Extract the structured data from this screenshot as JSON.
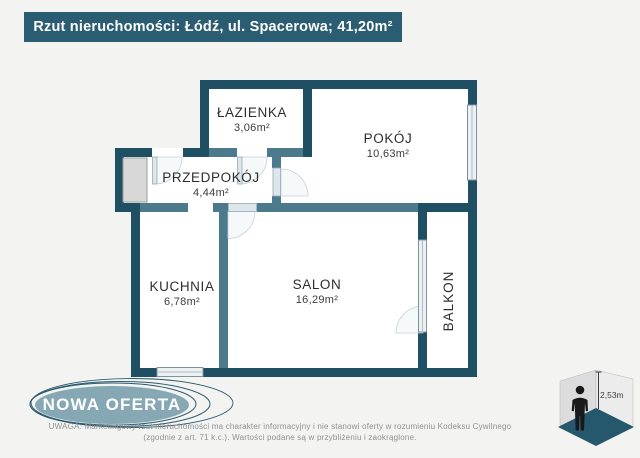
{
  "header": {
    "title": "Rzut nieruchomości: Łódź, ul. Spacerowa; 41,20m²"
  },
  "rooms": [
    {
      "name": "ŁAZIENKA",
      "area": "3,06m²"
    },
    {
      "name": "POKÓJ",
      "area": "10,63m²"
    },
    {
      "name": "PRZEDPOKÓJ",
      "area": "4,44m²"
    },
    {
      "name": "KUCHNIA",
      "area": "6,78m²"
    },
    {
      "name": "SALON",
      "area": "16,29m²"
    },
    {
      "name": "BALKON",
      "area": ""
    }
  ],
  "badge": {
    "label": "NOWA OFERTA"
  },
  "disclaimer": {
    "line1": "UWAGA: Marketingowy rzut nieruchomości ma charakter informacyjny i nie stanowi oferty w rozumieniu Kodeksu Cywilnego",
    "line2": "(zgodnie z art. 71 k.c.). Wartości podane są w przybliżeniu i zaokrąglone."
  },
  "height_indicator": {
    "value": "2,53m"
  },
  "colors": {
    "background": "#f3f4f2",
    "wall_exterior": "#1f4f63",
    "wall_interior": "#4a7a8c",
    "header_bg": "#2a5c72",
    "badge_fill": "#86a8b4",
    "floor_3d": "#25586d"
  }
}
